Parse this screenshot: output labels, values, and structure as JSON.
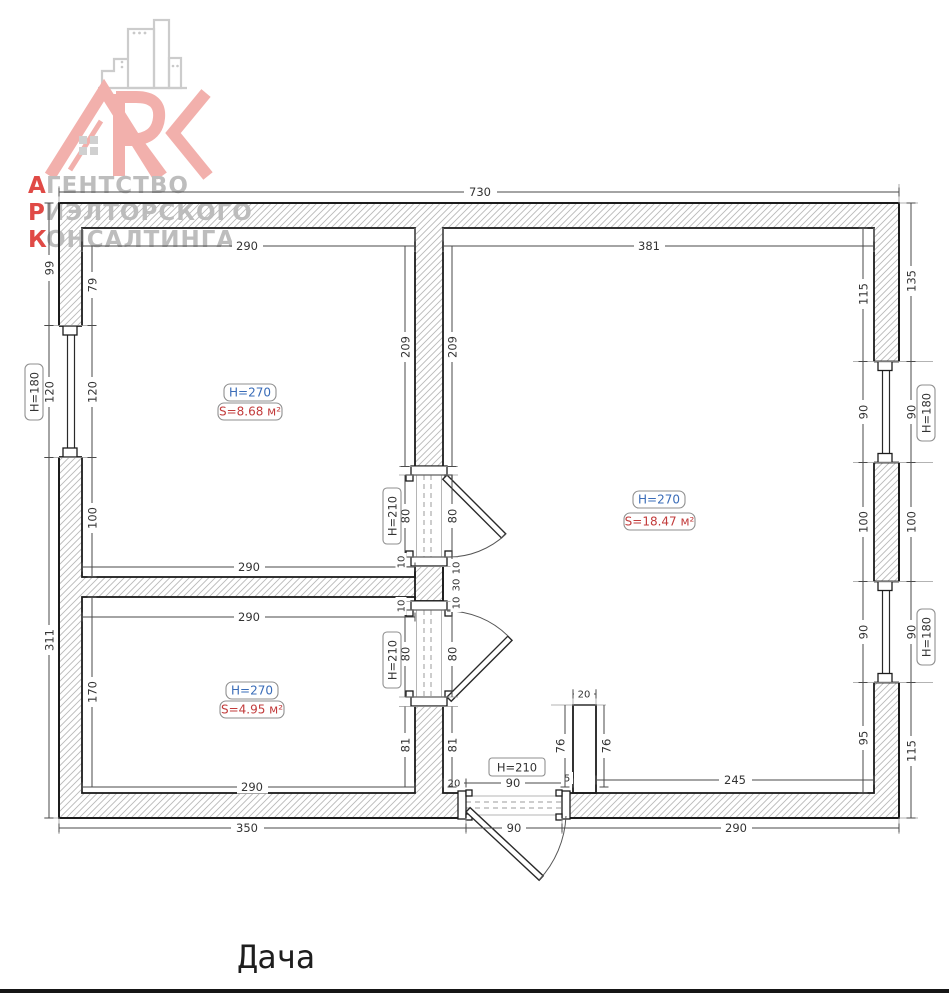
{
  "logo": {
    "brand": "ARK",
    "words": [
      {
        "initial": "А",
        "rest": "ГЕНТСТВО"
      },
      {
        "initial": "Р",
        "rest": "ИЭЛТОРСКОГО"
      },
      {
        "initial": "К",
        "rest": "ОНСАЛТИНГА"
      }
    ]
  },
  "plan_title": "Дача",
  "rooms": [
    {
      "id": "top-left",
      "height": "H=270",
      "area": "S=8.68 м²"
    },
    {
      "id": "right",
      "height": "H=270",
      "area": "S=18.47 м²"
    },
    {
      "id": "bottom-left",
      "height": "H=270",
      "area": "S=4.95 м²"
    }
  ],
  "labels": {
    "window_height": "H=180",
    "door_height": "H=210"
  },
  "dims": {
    "total_width": "730",
    "room_left_width": "290",
    "bigroom_width": "381",
    "out_99": "99",
    "win_left": "120",
    "out_311": "311",
    "in_79": "79",
    "in_100": "100",
    "room3_h": "170",
    "partition_h": "209",
    "door_w": "80",
    "frame": "10",
    "block": "30",
    "under_door": "81",
    "ent_left": "20",
    "ent_w": "90",
    "ent_right": "5",
    "stub_w": "20",
    "stub_h": "76",
    "bottom_inner": "245",
    "r_in_115": "115",
    "r_90": "90",
    "r_100": "100",
    "r_in_95": "95",
    "r_out_135": "135",
    "r_out_115": "115",
    "bottom_350": "350",
    "bottom_290": "290"
  },
  "colors": {
    "room_height": "#3a6cb8",
    "room_area": "#c23b3b",
    "logo_red": "#e04a46",
    "logo_gray": "#bdbdbd",
    "logo_pink": "#f2b0ac"
  }
}
